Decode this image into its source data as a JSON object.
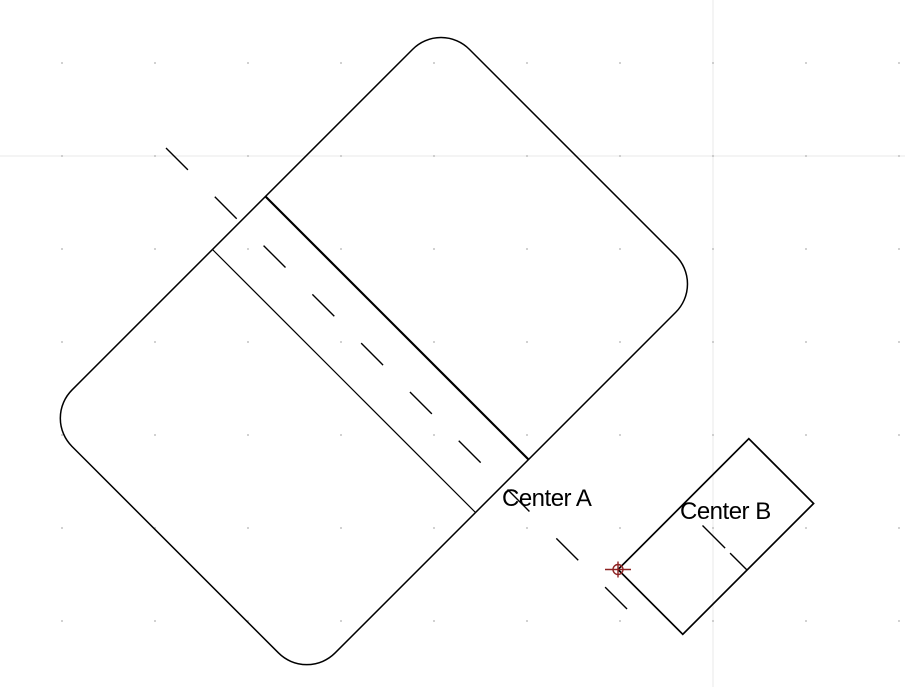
{
  "labels": {
    "center_a": "Center A",
    "center_b": "Center B"
  },
  "colors": {
    "background": "#ffffff",
    "line": "#000000",
    "text": "#000000",
    "grid_line": "#e8e8e8",
    "grid_dot": "#b0b0b0",
    "marker": "#8e2323"
  },
  "grid": {
    "spacing": 93,
    "dot_xs": [
      62,
      155,
      248,
      341,
      434,
      527,
      620,
      713,
      806,
      899
    ],
    "dot_ys": [
      63,
      156,
      249,
      342,
      435,
      528,
      621
    ],
    "axis_vertical_x": 713,
    "axis_horizontal_y": 156
  },
  "drawing": {
    "large_rounded_rect": {
      "center_x": 374,
      "center_y": 351,
      "length": 562,
      "width": 372,
      "corner_radius": 40,
      "rotation_deg": -45
    },
    "slot_band_upper_line": {
      "x1": 265.5,
      "y1": 196.5,
      "x2": 528.5,
      "y2": 459.5
    },
    "slot_band_lower_line": {
      "x1": 212.5,
      "y1": 249.5,
      "x2": 475.5,
      "y2": 512.5
    },
    "centerline_a": {
      "x1": 166,
      "y1": 148,
      "x2": 631,
      "y2": 613
    },
    "small_rect": {
      "center_x": 715.8,
      "center_y": 536.5,
      "length": 185,
      "width": 91.6,
      "rotation_deg": -45
    },
    "centerline_b": {
      "x1": 702.5,
      "y1": 525.5,
      "x2": 747,
      "y2": 570
    },
    "center_marker": {
      "x": 618,
      "y": 569.5,
      "radius": 5
    }
  }
}
